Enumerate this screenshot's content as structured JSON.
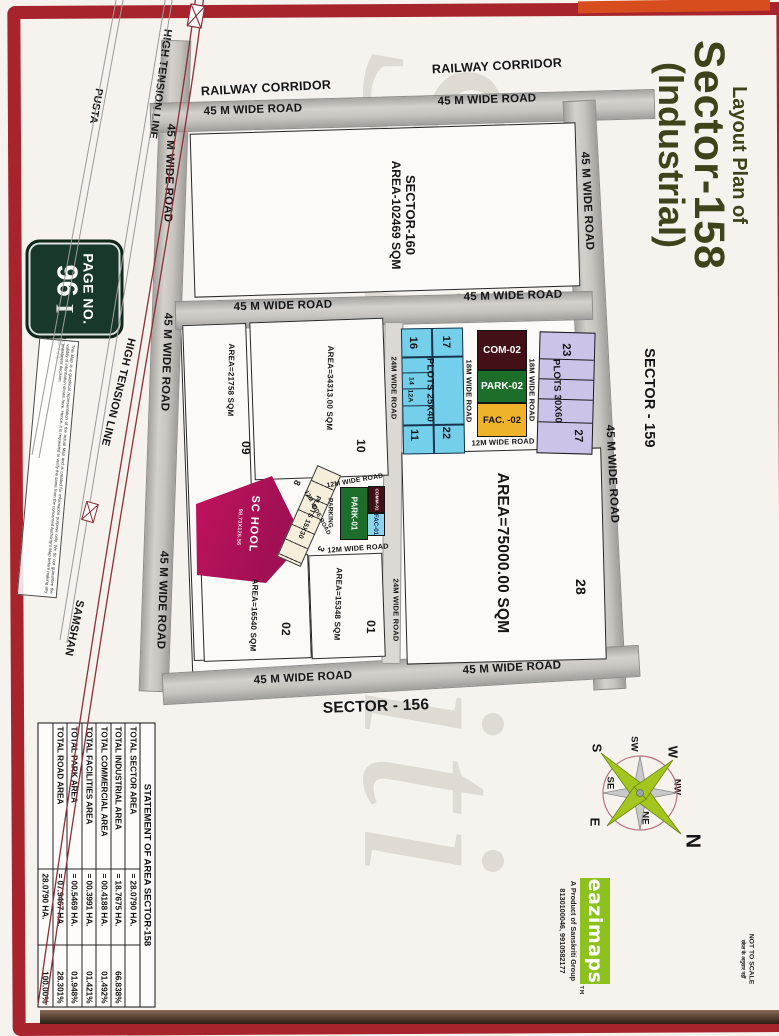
{
  "document": {
    "title": {
      "line1": "Layout Plan of",
      "line2": "Sector-158",
      "line3": "(Industrial)"
    },
    "page_badge": {
      "label": "PAGE NO.",
      "number": "96",
      "suffix": "I"
    },
    "scale_note": {
      "en": "NOT TO SCALE",
      "hi": "स्केल के अनुसार नहीं"
    },
    "watermark": "Sanskriti",
    "disclaimer": "This Map is a graphical representation of the actual Map and is created for information purpose only. We do not guarantee the validity of information shown here. Hence, it is requested to verify the same from the concerned Authority's Map before making any investment decision."
  },
  "landmarks": {
    "railway_corridor": "RAILWAY CORRIDOR",
    "high_tension_line": "HIGH TENSION LINE",
    "pusta": "PUSTA",
    "samshan": "SAMSHAN"
  },
  "sectors": {
    "s160_name": "SECTOR-160",
    "s160_area": "AREA-102469 SQM",
    "s159": "SECTOR - 159",
    "s156": "SECTOR - 156"
  },
  "roads": {
    "w45": "45 M WIDE ROAD",
    "w24": "24M WIDE ROAD",
    "w18": "18M WIDE ROAD",
    "w12": "12M WIDE ROAD"
  },
  "plots": {
    "p09": {
      "number": "09",
      "area": "AREA=21758 SQM"
    },
    "p10": {
      "number": "10",
      "area": "AREA=34313.00 SQM"
    },
    "p02": {
      "number": "02",
      "area": "AREA=16540 SQM"
    },
    "p01": {
      "number": "01",
      "area": "AREA=15348 SQM"
    },
    "p28": {
      "number": "28",
      "area": "AREA=75000.00 SQM"
    },
    "blue_strip": {
      "label": "PLOTS 25X40",
      "n17": "17",
      "n16": "16",
      "n14": "14",
      "n12a": "12A",
      "n22": "22",
      "n11": "11"
    },
    "purple_strip": {
      "label": "PLOTS 30X60",
      "n23": "23",
      "n27": "27"
    },
    "small_strip": {
      "label": "PLOTS 15X30",
      "n8": "8",
      "n3": "3"
    },
    "com02": "COM-02",
    "park02": "PARK-02",
    "fac02": "FAC. -02",
    "com01": "COMM-01",
    "park01": "PARK-01",
    "fac01": "FAC-01",
    "parking": "PARKING",
    "school": {
      "name": "SC HOOL",
      "dimensions": "98.73X126.56"
    }
  },
  "compass": {
    "n": "N",
    "ne": "NE",
    "e": "E",
    "se": "SE",
    "s": "S",
    "sw": "SW",
    "w": "W",
    "nw": "NW"
  },
  "branding": {
    "logo": "eazimaps",
    "tm": "TM",
    "tagline": "A Product of Sanskriti Group",
    "phone": "8130100046, 9910582177"
  },
  "area_statement": {
    "title": "STATEMENT OF AREA SECTOR-158",
    "rows": [
      {
        "label": "TOTAL SECTOR AREA",
        "value": "= 28.0790 HA.",
        "percent": ""
      },
      {
        "label": "TOTAL INDUSTRIAL AREA",
        "value": "= 18.7675 HA.",
        "percent": "66.838%"
      },
      {
        "label": "TOTAL COMMERCIAL AREA",
        "value": "= 00.4188 HA.",
        "percent": "01.492%"
      },
      {
        "label": "TOTAL FACILITIES AREA",
        "value": "= 00.3991 HA.",
        "percent": "01.421%"
      },
      {
        "label": "TOTAL PARK AREA",
        "value": "= 00.5469 HA.",
        "percent": "01.948%"
      },
      {
        "label": "TOTAL ROAD AREA",
        "value": "= 07.9467 HA.",
        "percent": "28.301%"
      },
      {
        "label": "",
        "value": "28.0790 HA.",
        "percent": "100.00%"
      }
    ]
  },
  "colors": {
    "frame_red": "#a8242c",
    "title_olive": "#3e431a",
    "badge_green": "#17382b",
    "school_magenta": "#b5135c",
    "park_green": "#1d6e2a",
    "com_maroon": "#441018",
    "facilities_amber": "#eeb22b",
    "fac_blue": "#8ed4ef",
    "plots_blue": "#74cfeb",
    "plots_purple": "#ccc4e8",
    "logo_green": "#8cc11e",
    "compass_green": "#a3c51e",
    "road_gray": "#c3c0bc",
    "ht_line_red": "#8d2e38"
  }
}
